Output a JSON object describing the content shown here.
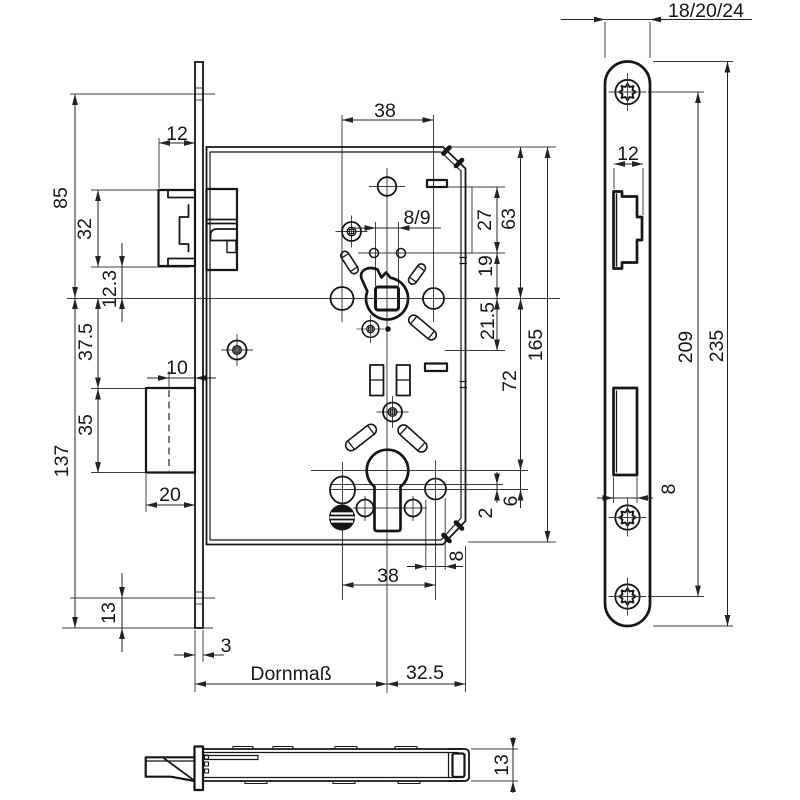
{
  "drawing_type": "mortise-lock technical drawing",
  "colors": {
    "background": "#ffffff",
    "line": "#161616",
    "dimension": "#232323"
  },
  "views": {
    "main": {
      "name": "lock case front view",
      "dims": {
        "d85": "85",
        "d137": "137",
        "d32": "32",
        "d12_3": "12.3",
        "d37_5": "37.5",
        "d35": "35",
        "d13": "13",
        "d12_latch": "12",
        "d10": "10",
        "d20": "20",
        "d3": "3",
        "backset": "Dornmaß",
        "d32_5": "32.5",
        "d38_top": "38",
        "d8_9": "8/9",
        "d27": "27",
        "d63": "63",
        "d19": "19",
        "d21_5": "21.5",
        "d165": "165",
        "d72": "72",
        "d2": "2",
        "d6": "6",
        "d8": "8",
        "d38_bottom": "38"
      }
    },
    "faceplate": {
      "name": "faceplate front view",
      "dims": {
        "width_options": "18/20/24",
        "d12": "12",
        "d8": "8",
        "d209": "209",
        "d235": "235"
      }
    },
    "bottom": {
      "name": "bottom edge view",
      "dims": {
        "d13": "13"
      }
    }
  }
}
